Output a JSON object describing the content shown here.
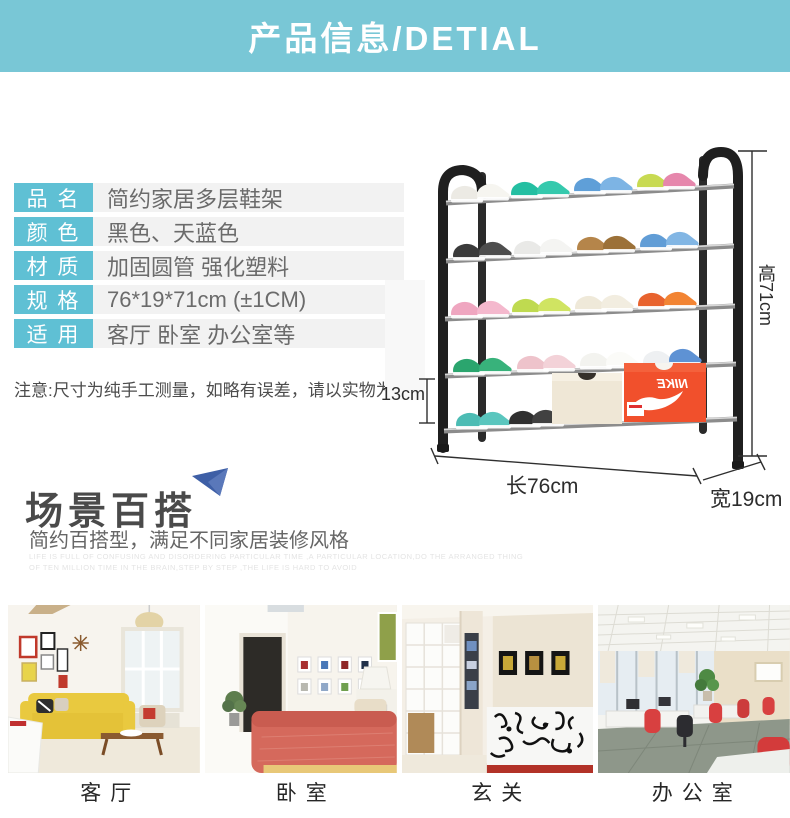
{
  "header": {
    "title": "产品信息/DETIAL"
  },
  "spec_table": {
    "rows": [
      {
        "label": "品 名",
        "value": "简约家居多层鞋架"
      },
      {
        "label": "颜 色",
        "value": "黑色、天蓝色"
      },
      {
        "label": "材 质",
        "value": "加固圆管 强化塑料"
      },
      {
        "label": "规 格",
        "value": "76*19*71cm (±1CM)"
      },
      {
        "label": "适 用",
        "value": "客厅 卧室 办公室等"
      }
    ]
  },
  "note": "注意:尺寸为纯手工测量，如略有误差，请以实物为准",
  "dimensions": {
    "height": "高71cm",
    "tier_gap": "13cm",
    "length": "长76cm",
    "depth": "宽19cm"
  },
  "rack": {
    "shoebox_brand": "NIKE",
    "tiers": 5
  },
  "scene_section": {
    "title": "场景百搭",
    "subtitle": "简约百搭型，满足不同家居装修风格",
    "watermark_line1": "LIFE IS FULL OF CONFUSING AND DISORDERING PARTICULAR TIME ,A PARTICULAR LOCATION,DO THE ARRANGED THING",
    "watermark_line2": "OF TEN MILLION TIME IN THE BRAIN,STEP BY STEP ,THE LIFE IS HARD TO AVOID"
  },
  "scenes": [
    {
      "label": "客厅"
    },
    {
      "label": "卧室"
    },
    {
      "label": "玄关"
    },
    {
      "label": "办公室"
    }
  ],
  "colors": {
    "header_teal": "#79c7d6",
    "label_teal": "#5fc0d4",
    "row_gray": "#f2f2f2",
    "accent_blue": "#3e5fa6",
    "nike_orange": "#f1502c"
  }
}
